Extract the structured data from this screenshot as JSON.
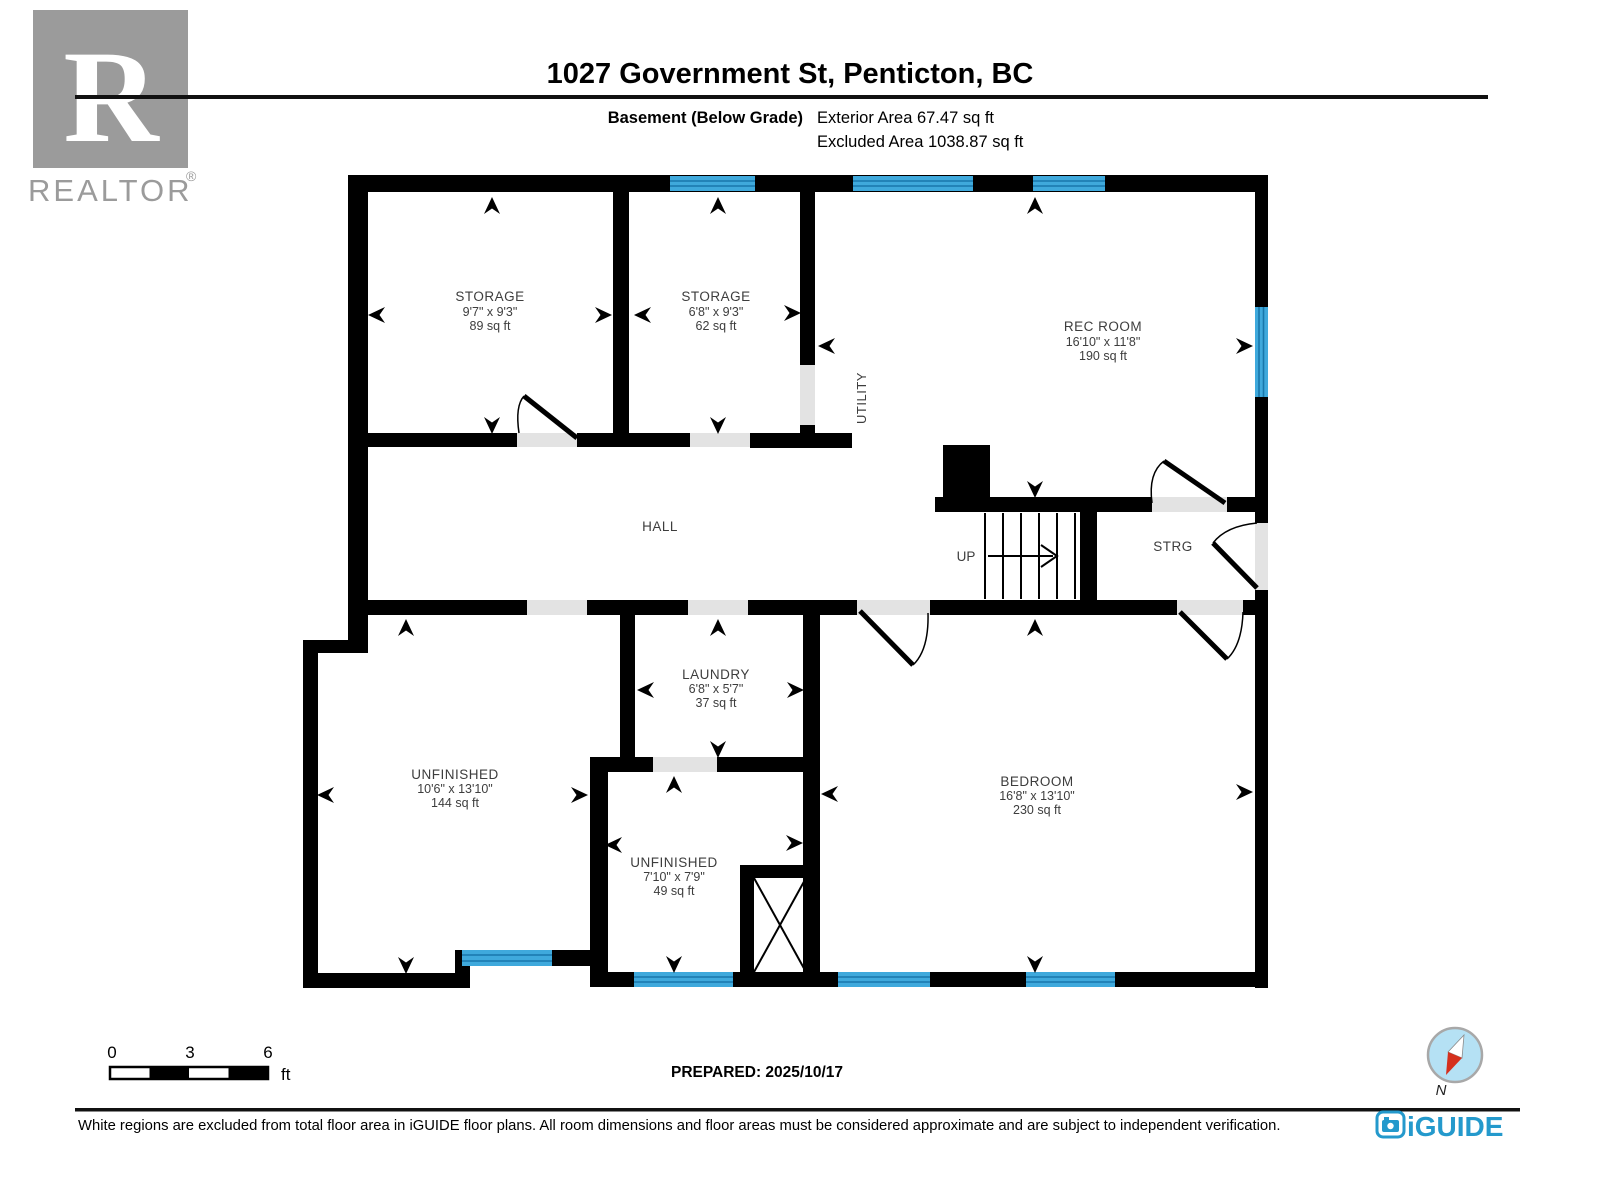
{
  "header": {
    "title": "1027 Government St, Penticton, BC",
    "floor_label": "Basement (Below Grade)",
    "area_line1": "Exterior Area 67.47 sq ft",
    "area_line2": "Excluded Area 1038.87 sq ft",
    "realtor_letter": "R",
    "realtor_text": "REALTOR",
    "realtor_reg": "®"
  },
  "rooms": {
    "storage1": {
      "name": "STORAGE",
      "dims": "9'7\" x 9'3\"",
      "area": "89 sq ft"
    },
    "storage2": {
      "name": "STORAGE",
      "dims": "6'8\" x 9'3\"",
      "area": "62 sq ft"
    },
    "rec_room": {
      "name": "REC ROOM",
      "dims": "16'10\" x 11'8\"",
      "area": "190 sq ft"
    },
    "utility": {
      "name": "UTILITY"
    },
    "hall": {
      "name": "HALL"
    },
    "stairs": {
      "label": "UP"
    },
    "strg": {
      "name": "STRG"
    },
    "laundry": {
      "name": "LAUNDRY",
      "dims": "6'8\" x 5'7\"",
      "area": "37 sq ft"
    },
    "unfinished1": {
      "name": "UNFINISHED",
      "dims": "10'6\" x 13'10\"",
      "area": "144 sq ft"
    },
    "unfinished2": {
      "name": "UNFINISHED",
      "dims": "7'10\" x 7'9\"",
      "area": "49 sq ft"
    },
    "bedroom": {
      "name": "BEDROOM",
      "dims": "16'8\" x 13'10\"",
      "area": "230 sq ft"
    }
  },
  "footer": {
    "scale": {
      "t0": "0",
      "t3": "3",
      "t6": "6",
      "unit": "ft"
    },
    "prepared": "PREPARED: 2025/10/17",
    "compass_label": "N",
    "disclaimer": "White regions are excluded from total floor area in iGUIDE floor plans. All room dimensions and floor areas must be considered approximate and are subject to independent verification.",
    "brand": "iGUIDE"
  },
  "colors": {
    "wall": "#000000",
    "window": "#3fa9dc",
    "window_stripe": "#1877ab",
    "door_gap": "#e3e3e3",
    "label": "#3d3d3d",
    "brand_blue": "#2499cc",
    "logo_gray": "#9b9b9b",
    "compass_fill": "#b5e1f4",
    "compass_ring": "#a8a8a8",
    "compass_red": "#d5301d",
    "rule": "#111111"
  }
}
